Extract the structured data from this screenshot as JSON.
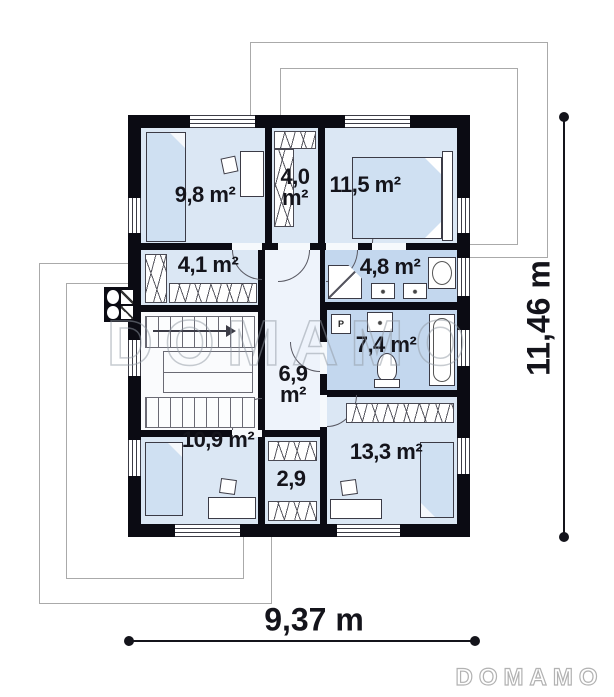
{
  "watermark_text": "DOMAMO",
  "brand_text": "DOMAMO",
  "dimensions": {
    "width": "9,37 m",
    "height": "11,46 m"
  },
  "rooms": {
    "bedroom1": {
      "area": "9,8 m²"
    },
    "wardrobe1": {
      "value": "4,0",
      "unit": "m²"
    },
    "bedroom2": {
      "area": "11,5 m²"
    },
    "closet1": {
      "area": "4,1 m²"
    },
    "bathroom1": {
      "area": "4,8 m²"
    },
    "bathroom2": {
      "area": "7,4 m²",
      "washer": "P"
    },
    "hall": {
      "value": "6,9",
      "unit": "m²"
    },
    "bedroom3": {
      "area": "10,9 m²"
    },
    "closet2": {
      "area": "2,9"
    },
    "bedroom4": {
      "area": "13,3 m²"
    }
  },
  "colors": {
    "wall": "#0b0b13",
    "room_fill": "#dbe7f4",
    "bath_fill": "#c3d7ee",
    "hall_fill": "#eef3fb",
    "stairs_fill": "#fafbfd",
    "bed_fill": "#cfe0f2",
    "furniture_line": "#3b3b46",
    "dim_color": "#14141b",
    "watermark_gray": "#9098a2",
    "roof_line": "#aaaaaa"
  }
}
